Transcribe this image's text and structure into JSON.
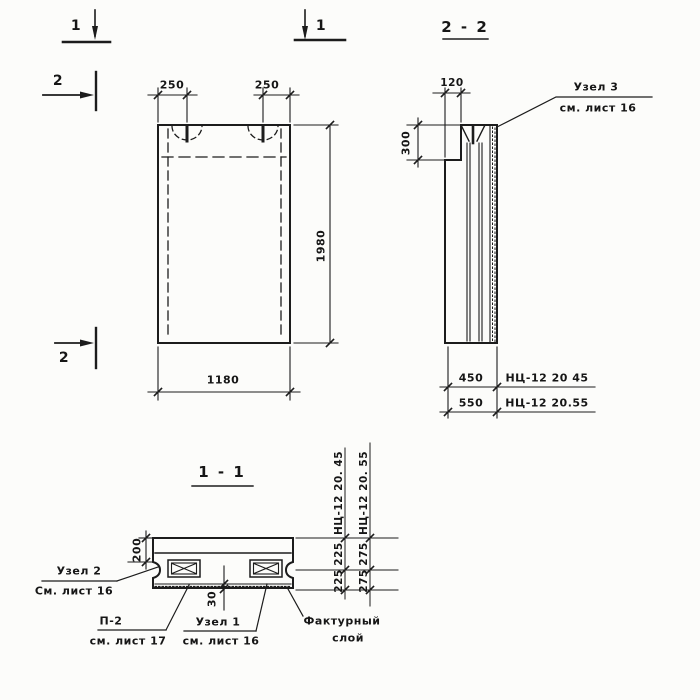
{
  "front": {
    "mark_1_left": "1",
    "mark_1_right": "1",
    "mark_2_top": "2",
    "mark_2_bottom": "2",
    "dim_250_left": "250",
    "dim_250_right": "250",
    "dim_height": "1980",
    "dim_width": "1180"
  },
  "s22": {
    "title": "2 - 2",
    "dim_120": "120",
    "dim_300": "300",
    "dim_450": "450",
    "dim_550": "550",
    "label_45": "НЦ-12 20 45",
    "label_55": "НЦ-12 20.55",
    "uzel3_line1": "Узел 3",
    "uzel3_line2": "см. лист 16"
  },
  "s11": {
    "title": "1 - 1",
    "dim_200": "200",
    "dim_30": "30",
    "dim_225_top": "225",
    "dim_225_bottom": "225",
    "dim_275_top": "275",
    "dim_275_bottom": "275",
    "label_45": "НЦ-12 20. 45",
    "label_55": "НЦ-12 20. 55",
    "uzel2_line1": "Узел 2",
    "uzel2_line2": "См. лист 16",
    "p2_line1": "П-2",
    "p2_line2": "см. лист 17",
    "uzel1_line1": "Узел 1",
    "uzel1_line2": "см. лист 16",
    "factura_line1": "Фактурный",
    "factura_line2": "слой"
  }
}
